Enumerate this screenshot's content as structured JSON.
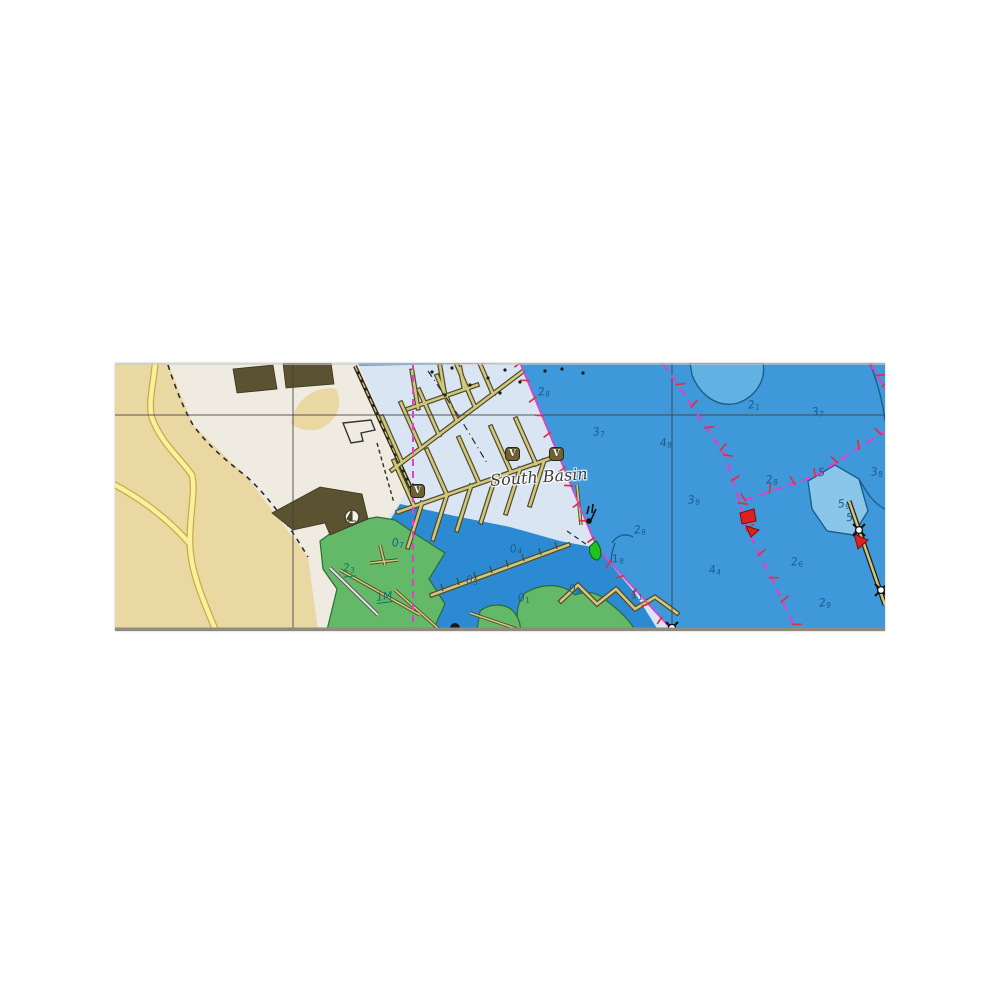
{
  "map": {
    "place_label": "South Basin",
    "marina_badge_label": "V",
    "soundings": [
      {
        "v": "2",
        "s": "8",
        "x": 423,
        "y": 23,
        "c": "navy"
      },
      {
        "v": "3",
        "s": "7",
        "x": 478,
        "y": 63,
        "c": "navy"
      },
      {
        "v": "4",
        "s": "8",
        "x": 545,
        "y": 74,
        "c": "navy"
      },
      {
        "v": "2",
        "s": "1",
        "x": 633,
        "y": 36,
        "c": "navy"
      },
      {
        "v": "3",
        "s": "7",
        "x": 697,
        "y": 43,
        "c": "navy"
      },
      {
        "v": "3",
        "s": "8",
        "x": 573,
        "y": 131,
        "c": "navy"
      },
      {
        "v": "2",
        "s": "8",
        "x": 651,
        "y": 111,
        "c": "navy"
      },
      {
        "v": "5",
        "s": "",
        "x": 703,
        "y": 104,
        "c": "navy"
      },
      {
        "v": "5",
        "s": "9",
        "x": 723,
        "y": 135,
        "c": "navy"
      },
      {
        "v": "3",
        "s": "8",
        "x": 756,
        "y": 103,
        "c": "navy"
      },
      {
        "v": "2",
        "s": "8",
        "x": 519,
        "y": 161,
        "c": "navy"
      },
      {
        "v": "1",
        "s": "8",
        "x": 497,
        "y": 190,
        "c": "navy"
      },
      {
        "v": "1",
        "s": "1",
        "x": 516,
        "y": 226,
        "c": "navy"
      },
      {
        "v": "4",
        "s": "4",
        "x": 594,
        "y": 201,
        "c": "navy"
      },
      {
        "v": "2",
        "s": "6",
        "x": 676,
        "y": 193,
        "c": "navy"
      },
      {
        "v": "2",
        "s": "9",
        "x": 704,
        "y": 234,
        "c": "navy"
      },
      {
        "v": "5",
        "s": "",
        "x": 731,
        "y": 149,
        "c": "navy"
      },
      {
        "v": "0",
        "s": "4",
        "x": 395,
        "y": 180,
        "c": "navy"
      },
      {
        "v": "0",
        "s": "5",
        "x": 351,
        "y": 211,
        "c": "navy"
      },
      {
        "v": "0",
        "s": "4",
        "x": 454,
        "y": 220,
        "c": "navy"
      },
      {
        "v": "0",
        "s": "7",
        "x": 277,
        "y": 174,
        "c": "navy"
      },
      {
        "v": "0",
        "s": "1",
        "x": 403,
        "y": 229,
        "c": "navy"
      },
      {
        "v": "2",
        "s": "3",
        "x": 228,
        "y": 199,
        "c": "teal",
        "u": true
      },
      {
        "v": "1M",
        "s": "",
        "x": 261,
        "y": 228,
        "c": "teal",
        "u": true
      }
    ],
    "badges": [
      {
        "x": 390,
        "y": 84
      },
      {
        "x": 434,
        "y": 84
      },
      {
        "x": 295,
        "y": 121
      }
    ],
    "icons": {
      "yacht_harbor": "circle-sailboat",
      "red_buoy": "red-pennant",
      "green_buoy": "green-cone",
      "mooring_dolphin": "star-circle-pile"
    },
    "colors": {
      "water_deep": "#3e98d9",
      "water_inner": "#2c8ad3",
      "water_pale": "#d9e5f2",
      "water_lobe": "#62b1e3",
      "water_shoal": "#8ac6e9",
      "shoal_line": "#1a5f8a",
      "land_tan": "#e9d8a2",
      "land_light": "#efebe0",
      "road_fill": "#f7f19a",
      "road_edge": "#c9a94f",
      "green_flat": "#63b968",
      "green_edge": "#2e6b36",
      "pier_fill": "#d2c77f",
      "pier_edge": "#4f4a28",
      "building": "#5a5230",
      "magenta": "#e93ccb",
      "tick_red": "#d93440",
      "grid": "#3e3e3e",
      "snd_navy": "#1e5c8d",
      "snd_teal": "#0d7a65",
      "badge_bg": "#6e6233",
      "badge_border": "#2a2415",
      "buoy_red": "#e02020",
      "buoy_green": "#1ec41e",
      "dashed_black": "#2b2b2b",
      "edge_strip": "#8f8c7f"
    }
  }
}
